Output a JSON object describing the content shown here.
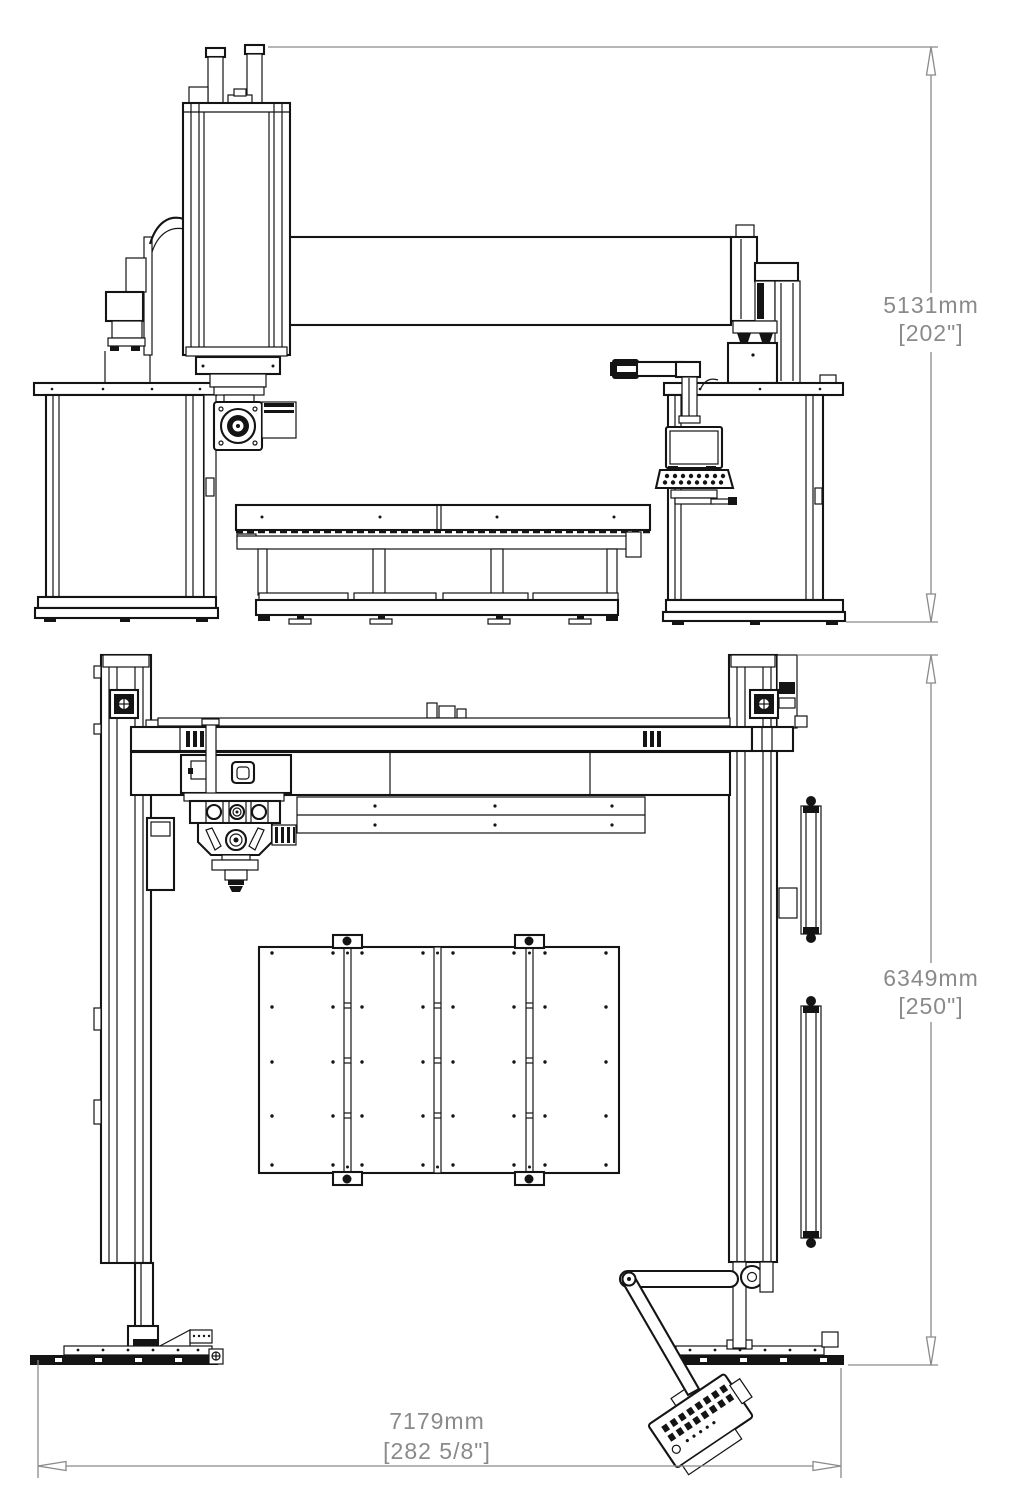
{
  "drawing": {
    "type": "technical-dimension-drawing",
    "views": {
      "front": "front-elevation",
      "plan": "top-plan"
    },
    "dimensions": {
      "height": {
        "metric": "5131mm",
        "imperial": "[202\"]"
      },
      "depth": {
        "metric": "6349mm",
        "imperial": "[250\"]"
      },
      "width": {
        "metric": "7179mm",
        "imperial": "[282 5/8\"]"
      }
    },
    "colors": {
      "line": "#141414",
      "dimension": "#8a8a8a",
      "background": "#ffffff"
    }
  }
}
